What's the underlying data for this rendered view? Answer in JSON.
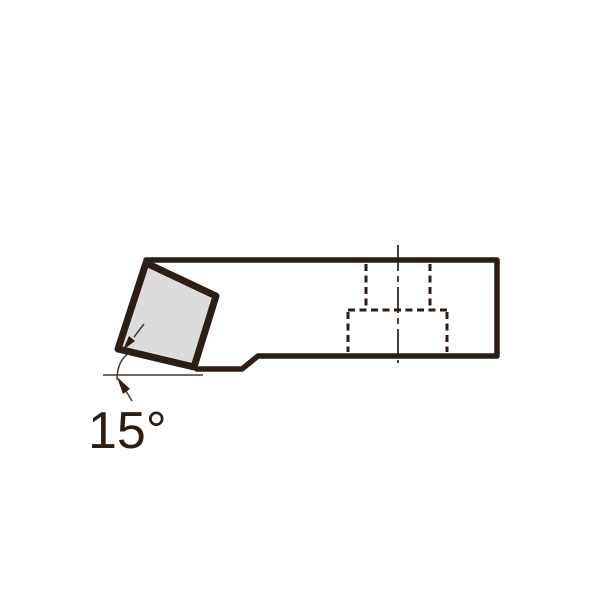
{
  "diagram": {
    "angle_label": "15°"
  },
  "colors": {
    "line": "#2c1d15",
    "thin-line": "#463830",
    "insert-fill": "#dbdcdc",
    "background": "#ffffff"
  },
  "geometry": {
    "holder_body": "M 197 369 L 242 369 L 258 356 L 497 356 L 497 260 L 146 260",
    "insert_points": "146,263 216,296 194,367 118,349",
    "slot_hidden_left": "M 366 264 L 366 308",
    "slot_hidden_right": "M 430 264 L 430 308",
    "pocket_hidden_top": "M 348 310 L 447 310",
    "pocket_hidden_left": "M 348 312 L 348 352",
    "pocket_hidden_right": "M 447 312 L 447 352",
    "center_line": "M 398 245 L 398 363",
    "angle_baseline": "M 103 375 L 203 375",
    "angle_arc": "M 129 353 Q 117 361 117 380",
    "arrow_upper_tail": "M 134 337 L 144 324",
    "arrow_upper_head": "123,350 135,341 129,336",
    "arrow_lower_tail": "M 126 391 L 132 401",
    "arrow_lower_head": "117,377 130,389 123,394",
    "label_x": "88",
    "label_y": "448"
  }
}
